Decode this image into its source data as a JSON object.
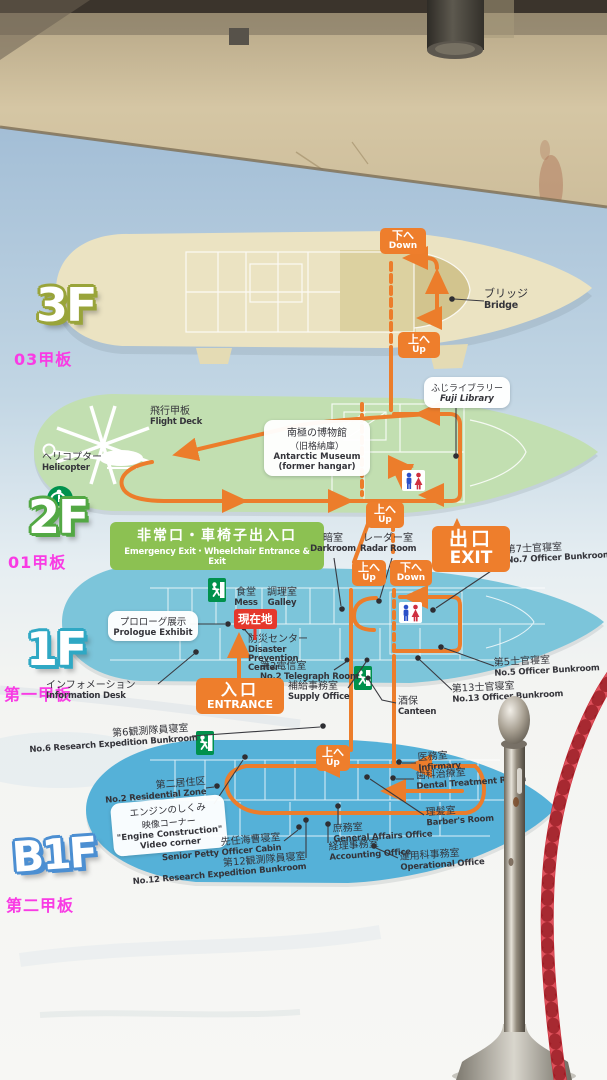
{
  "colors": {
    "route_orange": "#ec7d2b",
    "magenta": "#f93be4",
    "deck_3f": "#ebe3c2",
    "deck_2f": "#c2dfb1",
    "deck_1f": "#7cc5da",
    "deck_b1f": "#55b1d8",
    "banner_green": "#8cc152",
    "exit_green": "#00914c",
    "here_red": "#e5382c",
    "rope_red": "#c32531"
  },
  "nav": {
    "up_jp": "上へ",
    "up_en": "Up",
    "down_jp": "下へ",
    "down_en": "Down"
  },
  "f3": {
    "logo": "3F",
    "deck": "03甲板",
    "bridge_jp": "ブリッジ",
    "bridge_en": "Bridge"
  },
  "f2": {
    "logo": "2F",
    "deck": "01甲板",
    "flight_jp": "飛行甲板",
    "flight_en": "Flight Deck",
    "heli_jp": "ヘリコプター",
    "heli_en": "Helicopter",
    "museum_jp1": "南極の博物館",
    "museum_jp2": "（旧格納庫）",
    "museum_en1": "Antarctic Museum",
    "museum_en2": "(former hangar)",
    "library_jp": "ふじライブラリー",
    "library_en": "Fuji Library",
    "banner_jp": "非常口・車椅子出入口",
    "banner_en": "Emergency Exit・Wheelchair Entrance & Exit"
  },
  "f1": {
    "logo": "1F",
    "deck": "第一甲板",
    "darkroom_jp": "暗室",
    "darkroom_en": "Darkroom",
    "radar_jp": "レーダー室",
    "radar_en": "Radar Room",
    "exit_jp": "出口",
    "exit_en": "EXIT",
    "no7_jp": "第7士官寝室",
    "no7_en": "No.7 Officer Bunkroom",
    "mess_jp": "食堂",
    "mess_en": "Mess",
    "galley_jp": "調理室",
    "galley_en": "Galley",
    "here": "現在地",
    "prologue_jp": "プロローグ展示",
    "prologue_en": "Prologue Exhibit",
    "disaster_jp": "防災センター",
    "disaster_en": "Disaster Prevention Center",
    "telegraph_jp": "第2電信室",
    "telegraph_en": "No.2 Telegraph Room",
    "info_jp": "インフォメーション",
    "info_en": "Information Desk",
    "entrance_jp": "入口",
    "entrance_en": "ENTRANCE",
    "supply_jp": "補給事務室",
    "supply_en": "Supply Office",
    "canteen_jp": "酒保",
    "canteen_en": "Canteen",
    "no13_jp": "第13士官寝室",
    "no13_en": "No.13 Officer Bunkroom",
    "no5_jp": "第5士官寝室",
    "no5_en": "No.5 Officer Bunkroom"
  },
  "b1": {
    "logo": "B1F",
    "deck": "第二甲板",
    "no6_jp": "第6観測隊員寝室",
    "no6_en": "No.6 Research Expedition Bunkroom",
    "residential_jp": "第二居住区",
    "residential_en": "No.2 Residential Zone",
    "engine_jp1": "エンジンのしくみ",
    "engine_jp2": "映像コーナー",
    "engine_en1": "\"Engine Construction\"",
    "engine_en2": "Video corner",
    "infirmary_jp": "医務室",
    "infirmary_en": "Infirmary",
    "dental_jp": "歯科治療室",
    "dental_en": "Dental Treatment Room",
    "barber_jp": "理髪室",
    "barber_en": "Barber's Room",
    "general_jp": "庶務室",
    "general_en": "General Affairs Office",
    "senior_jp": "先任海曹寝室",
    "senior_en": "Senior Petty Officer Cabin",
    "accounting_jp": "経理事務室",
    "accounting_en": "Accounting Office",
    "no12_jp": "第12観測隊員寝室",
    "no12_en": "No.12 Research Expedition Bunkroom",
    "operational_jp": "運用科事務室",
    "operational_en": "Operational Office"
  },
  "icons": {
    "restroom": "male-female restroom figures",
    "emergency_exit": "green running-man exit",
    "wheelchair": "wheelchair accessible",
    "helicopter": "helicopter silhouette",
    "you_are_here": "red location badge",
    "stanchion": "chrome rope stanchion",
    "rope": "red barrier rope"
  }
}
